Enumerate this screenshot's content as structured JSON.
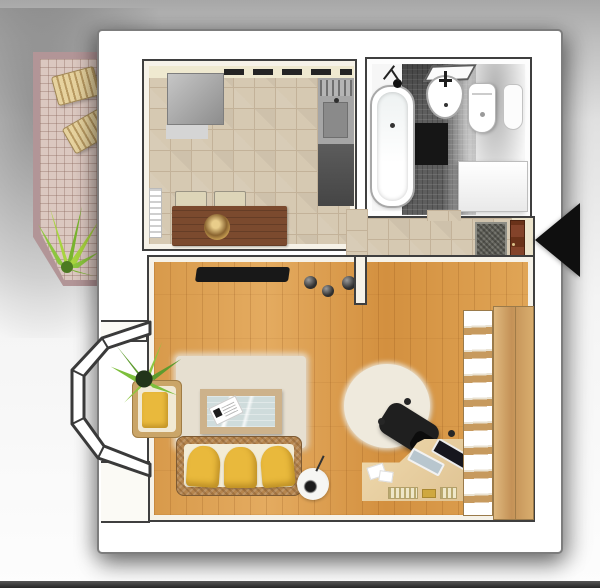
{
  "meta": {
    "description": "3D rendered top-down floor plan of a one-room studio apartment on a white photo card with a balcony graphic breaking out of the frame"
  },
  "navigation": {
    "prev_arrow": {
      "direction": "left",
      "shape": "solid-triangle",
      "color": "#0f0f0f"
    }
  },
  "scene": {
    "rooms": [
      {
        "name": "balcony",
        "floor": "pink-tile-grid",
        "furniture": [
          "wooden-lounger",
          "wooden-lounger",
          "green-plant"
        ]
      },
      {
        "name": "kitchen",
        "floor": "beige-tile",
        "furniture": [
          "refrigerator",
          "counter-with-hob",
          "sink-counter",
          "radiator",
          "dining-table",
          "dining-chair",
          "dining-chair",
          "dining-chair",
          "decor-bowl"
        ]
      },
      {
        "name": "bathroom",
        "floor": "dark-mosaic",
        "furniture": [
          "bathtub",
          "shower-fixture",
          "washbasin",
          "mirror",
          "toilet",
          "bidet",
          "washing-machine",
          "black-mat"
        ]
      },
      {
        "name": "hallway",
        "floor": "beige-tile",
        "furniture": [
          "entrance-door",
          "doormat",
          "shoe-bench"
        ]
      },
      {
        "name": "living-room",
        "floor": "wood-planks",
        "furniture": [
          "tv",
          "vase",
          "vase",
          "vase",
          "area-rug",
          "coffee-table",
          "magazine",
          "sofa",
          "yellow-cushion",
          "yellow-cushion",
          "yellow-cushion",
          "armchair",
          "potted-plant",
          "bay-window",
          "floor-lamp",
          "round-rug",
          "office-chair",
          "desk",
          "laptop",
          "laptop",
          "keyboard",
          "wardrobe"
        ]
      }
    ]
  },
  "colors": {
    "bg_top": "#a7a7a7",
    "card_bg": "#ffffff",
    "card_border": "#7d7d7d",
    "wall_outline": "#3f3f3f",
    "wall_fill": "#f6f2e8",
    "tile_floor": "#d6c9b2",
    "tile_line": "#c3b299",
    "wood_floor": "#dc9e50",
    "mosaic_dark": "#5e5e5e",
    "rug_beige": "#e6dfd0",
    "rug_round": "#efeadd",
    "sofa_frame": "#b5854e",
    "sofa_inner": "#f3ecd6",
    "cushion_yellow": "#e9b93c",
    "table_brown": "#7b4a2e",
    "chair_beige": "#ddd5b8",
    "counter_gray": "#a6a6a6",
    "doormat": "#62625a",
    "mat_black": "#161616",
    "bench_wood": "#cdb183",
    "door_brown": "#7a3c20",
    "desk_wood": "#e9d2a4",
    "wardrobe_wood": "#c79a5e",
    "wardrobe_panel": "#ffffff",
    "balcony_rail": "#b29597",
    "balcony_tile": "#dbc8c0",
    "lounger_light": "#e6d29e",
    "lounger_dark": "#b89a62",
    "plant_light": "#8cc63e",
    "plant_dark": "#33511f",
    "glass_blue": "#cfdcdc",
    "tv_black": "#181818",
    "arrow_black": "#0f0f0f",
    "bottom_bar": "#262626"
  }
}
